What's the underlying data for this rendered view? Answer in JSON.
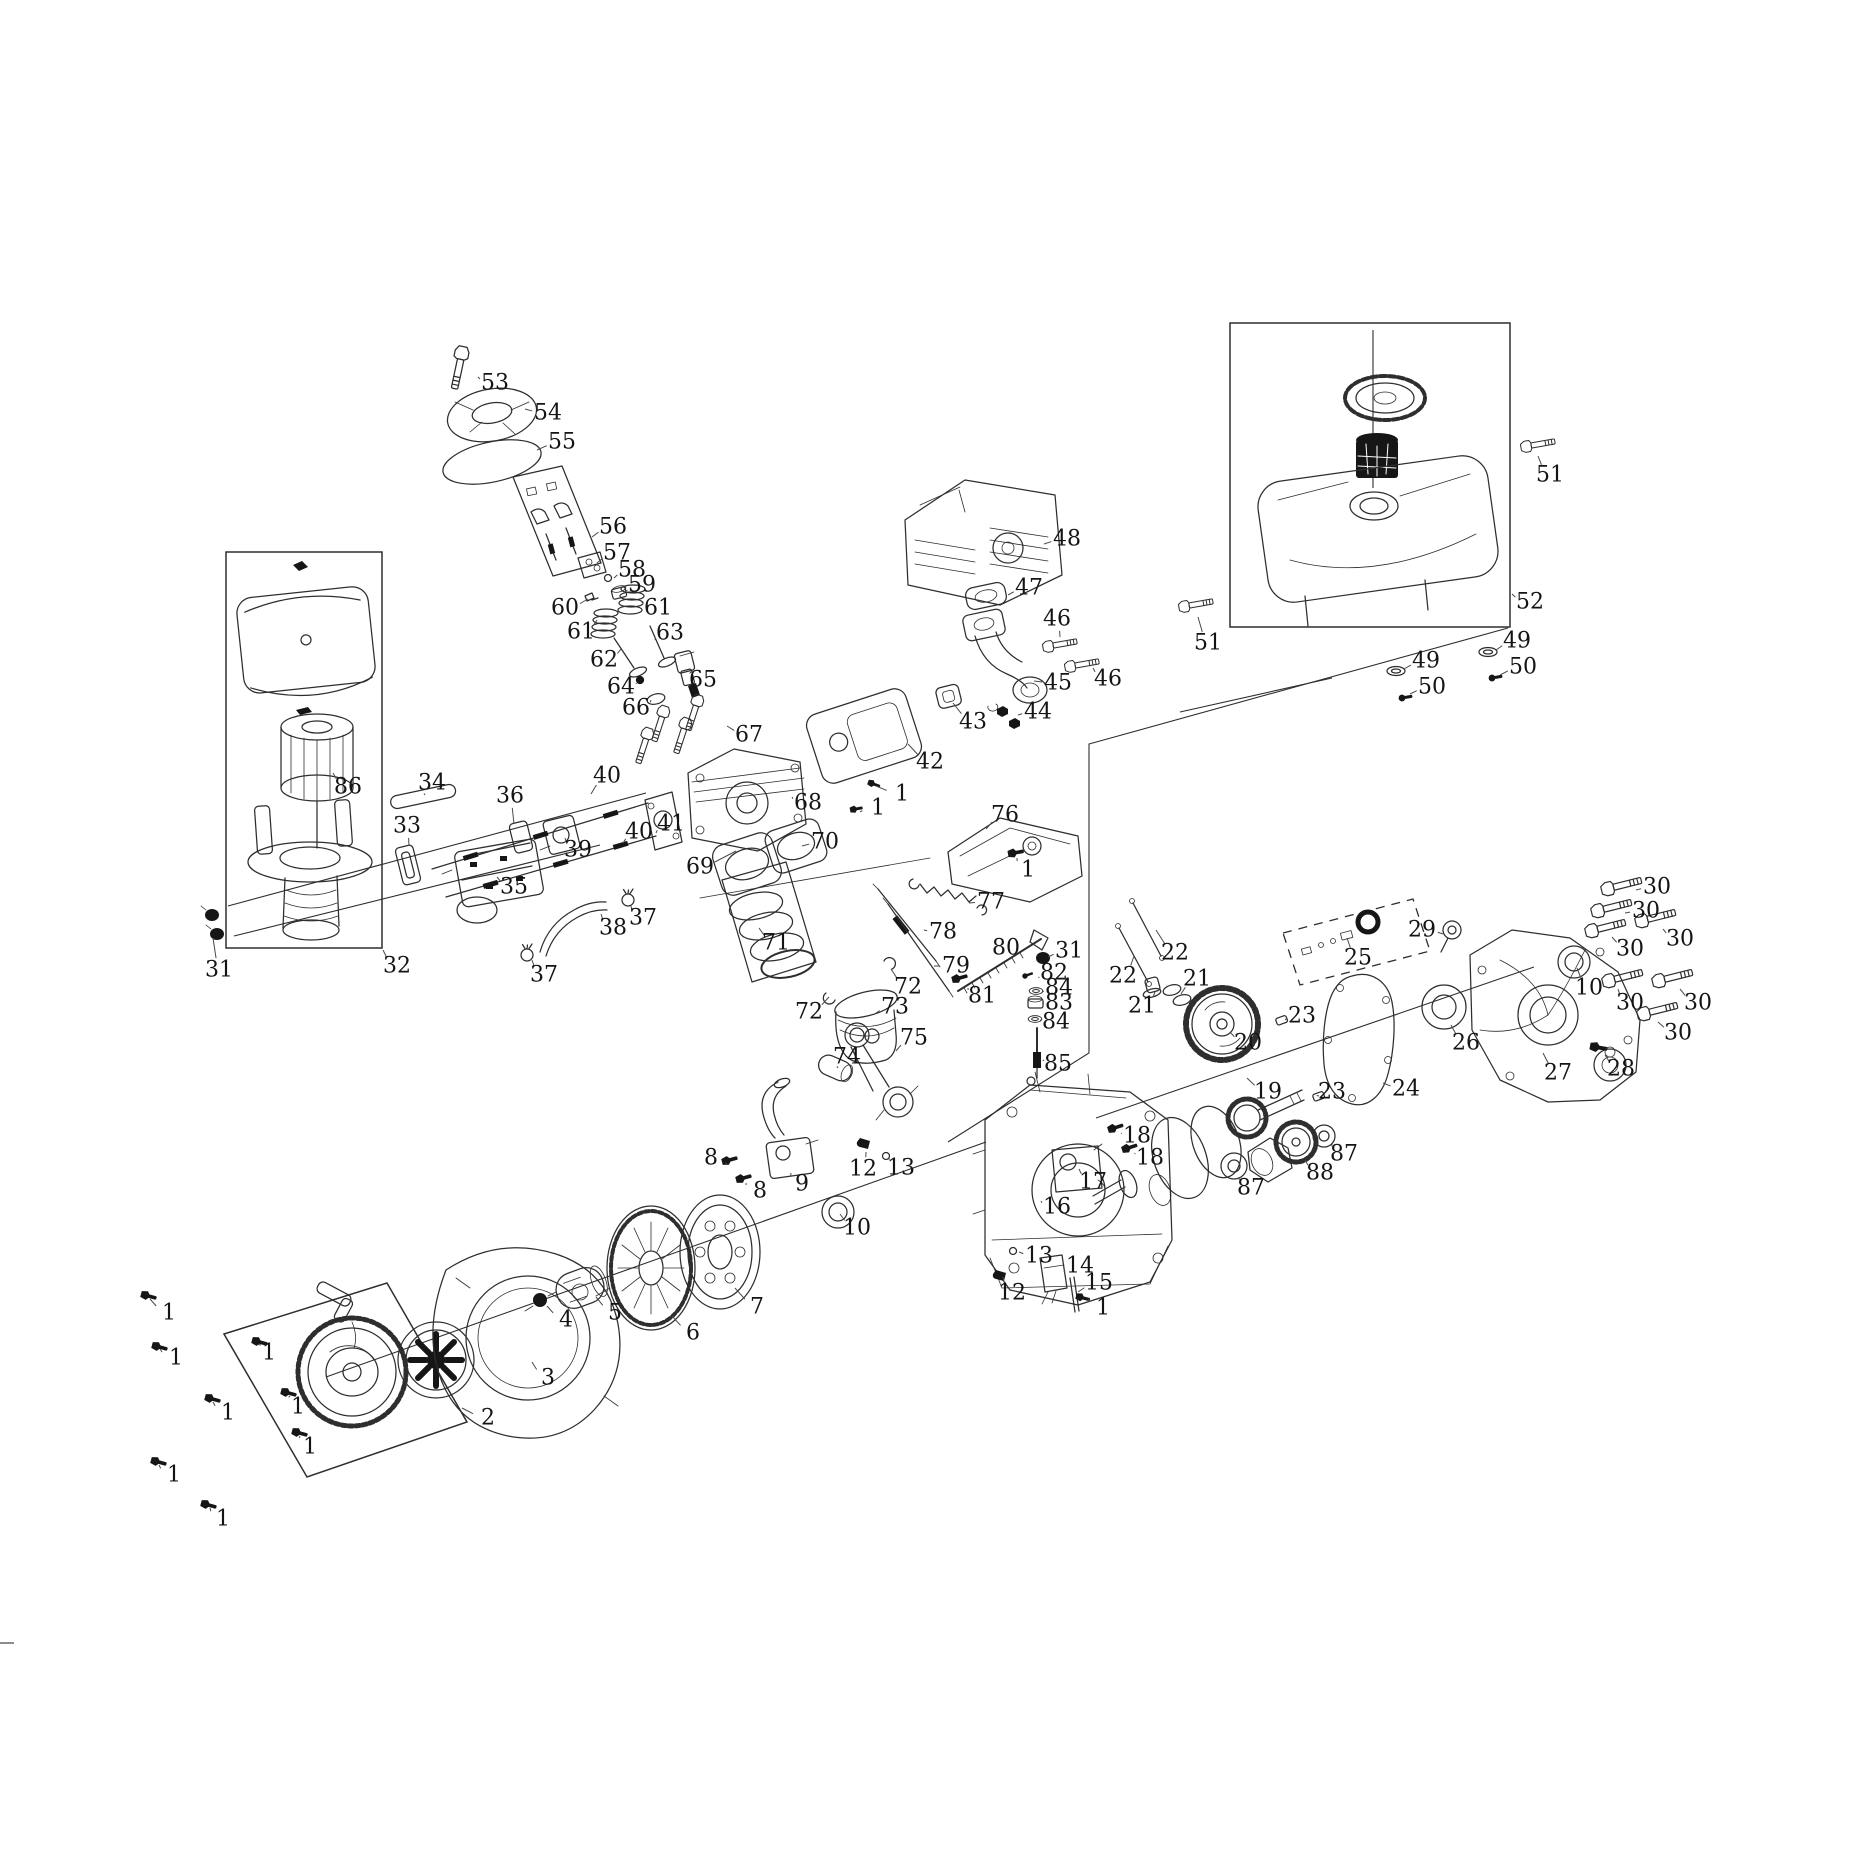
{
  "figure": {
    "kind": "exploded-view-parts-diagram",
    "subject": "small-gasoline-engine",
    "part_number_min": 1,
    "part_number_max": 88,
    "line_color": "#2e2e2e",
    "background_color": "#ffffff"
  },
  "callouts": [
    {
      "n": "53",
      "x": 495,
      "y": 383,
      "tx": 478,
      "ty": 377
    },
    {
      "n": "54",
      "x": 548,
      "y": 413,
      "tx": 525,
      "ty": 409
    },
    {
      "n": "55",
      "x": 562,
      "y": 442,
      "tx": 537,
      "ty": 450
    },
    {
      "n": "56",
      "x": 613,
      "y": 527,
      "tx": 592,
      "ty": 537
    },
    {
      "n": "57",
      "x": 617,
      "y": 553,
      "tx": 597,
      "ty": 563
    },
    {
      "n": "58",
      "x": 632,
      "y": 570,
      "tx": 614,
      "ty": 578
    },
    {
      "n": "59",
      "x": 642,
      "y": 585,
      "tx": 624,
      "ty": 593
    },
    {
      "n": "60",
      "x": 565,
      "y": 608,
      "tx": 588,
      "ty": 599
    },
    {
      "n": "61",
      "x": 658,
      "y": 608,
      "tx": 641,
      "ty": 601
    },
    {
      "n": "61",
      "x": 581,
      "y": 632,
      "tx": 597,
      "ty": 620
    },
    {
      "n": "62",
      "x": 604,
      "y": 660,
      "tx": 621,
      "ty": 649
    },
    {
      "n": "63",
      "x": 670,
      "y": 633,
      "tx": 655,
      "ty": 640
    },
    {
      "n": "64",
      "x": 621,
      "y": 687,
      "tx": 636,
      "ty": 683
    },
    {
      "n": "65",
      "x": 703,
      "y": 680,
      "tx": 691,
      "ty": 672
    },
    {
      "n": "66",
      "x": 636,
      "y": 708,
      "tx": 651,
      "ty": 700
    },
    {
      "n": "67",
      "x": 749,
      "y": 735,
      "tx": 727,
      "ty": 726
    },
    {
      "n": "68",
      "x": 808,
      "y": 803,
      "tx": 792,
      "ty": 797
    },
    {
      "n": "69",
      "x": 700,
      "y": 867,
      "tx": 736,
      "ty": 851
    },
    {
      "n": "70",
      "x": 825,
      "y": 842,
      "tx": 802,
      "ty": 846
    },
    {
      "n": "71",
      "x": 776,
      "y": 943,
      "tx": 759,
      "ty": 928
    },
    {
      "n": "72",
      "x": 908,
      "y": 987,
      "tx": 891,
      "ty": 969
    },
    {
      "n": "72",
      "x": 809,
      "y": 1012,
      "tx": 829,
      "ty": 997
    },
    {
      "n": "73",
      "x": 895,
      "y": 1007,
      "tx": 876,
      "ty": 1013
    },
    {
      "n": "74",
      "x": 847,
      "y": 1057,
      "tx": 838,
      "ty": 1068
    },
    {
      "n": "75",
      "x": 914,
      "y": 1038,
      "tx": 896,
      "ty": 1051
    },
    {
      "n": "76",
      "x": 1005,
      "y": 815,
      "tx": 986,
      "ty": 829
    },
    {
      "n": "77",
      "x": 991,
      "y": 902,
      "tx": 969,
      "ty": 903
    },
    {
      "n": "78",
      "x": 943,
      "y": 932,
      "tx": 924,
      "ty": 930
    },
    {
      "n": "79",
      "x": 956,
      "y": 966,
      "tx": 934,
      "ty": 966
    },
    {
      "n": "80",
      "x": 1006,
      "y": 948,
      "tx": 1009,
      "ty": 959
    },
    {
      "n": "81",
      "x": 982,
      "y": 996,
      "tx": 968,
      "ty": 988
    },
    {
      "n": "82",
      "x": 1054,
      "y": 973,
      "tx": 1039,
      "ty": 978
    },
    {
      "n": "83",
      "x": 1059,
      "y": 1003,
      "tx": 1044,
      "ty": 1003
    },
    {
      "n": "84",
      "x": 1059,
      "y": 988,
      "tx": 1043,
      "ty": 992
    },
    {
      "n": "84",
      "x": 1056,
      "y": 1022,
      "tx": 1041,
      "ty": 1020
    },
    {
      "n": "85",
      "x": 1058,
      "y": 1064,
      "tx": 1044,
      "ty": 1060
    },
    {
      "n": "86",
      "x": 348,
      "y": 787,
      "tx": 333,
      "ty": 773
    },
    {
      "n": "31",
      "x": 219,
      "y": 970,
      "tx": 213,
      "ty": 938
    },
    {
      "n": "31",
      "x": 1069,
      "y": 951,
      "tx": 1048,
      "ty": 957
    },
    {
      "n": "32",
      "x": 397,
      "y": 966,
      "tx": 383,
      "ty": 950
    },
    {
      "n": "33",
      "x": 407,
      "y": 826,
      "tx": 409,
      "ty": 846
    },
    {
      "n": "34",
      "x": 432,
      "y": 783,
      "tx": 425,
      "ty": 795
    },
    {
      "n": "35",
      "x": 514,
      "y": 887,
      "tx": 497,
      "ty": 877
    },
    {
      "n": "36",
      "x": 510,
      "y": 796,
      "tx": 514,
      "ty": 824
    },
    {
      "n": "37",
      "x": 643,
      "y": 918,
      "tx": 631,
      "ty": 906
    },
    {
      "n": "37",
      "x": 544,
      "y": 975,
      "tx": 532,
      "ty": 960
    },
    {
      "n": "38",
      "x": 613,
      "y": 928,
      "tx": 601,
      "ty": 914
    },
    {
      "n": "39",
      "x": 578,
      "y": 850,
      "tx": 565,
      "ty": 838
    },
    {
      "n": "40",
      "x": 607,
      "y": 776,
      "tx": 591,
      "ty": 794
    },
    {
      "n": "40",
      "x": 639,
      "y": 832,
      "tx": 623,
      "ty": 843
    },
    {
      "n": "41",
      "x": 671,
      "y": 824,
      "tx": 656,
      "ty": 833
    },
    {
      "n": "42",
      "x": 930,
      "y": 762,
      "tx": 908,
      "ty": 744
    },
    {
      "n": "43",
      "x": 973,
      "y": 722,
      "tx": 953,
      "ty": 703
    },
    {
      "n": "44",
      "x": 1038,
      "y": 712,
      "tx": 1018,
      "ty": 715
    },
    {
      "n": "45",
      "x": 1058,
      "y": 683,
      "tx": 1034,
      "ty": 681
    },
    {
      "n": "46",
      "x": 1057,
      "y": 619,
      "tx": 1060,
      "ty": 637
    },
    {
      "n": "46",
      "x": 1108,
      "y": 679,
      "tx": 1093,
      "ty": 668
    },
    {
      "n": "47",
      "x": 1029,
      "y": 588,
      "tx": 1008,
      "ty": 595
    },
    {
      "n": "48",
      "x": 1067,
      "y": 539,
      "tx": 1044,
      "ty": 544
    },
    {
      "n": "49",
      "x": 1517,
      "y": 641,
      "tx": 1496,
      "ty": 650
    },
    {
      "n": "49",
      "x": 1426,
      "y": 661,
      "tx": 1404,
      "ty": 669
    },
    {
      "n": "50",
      "x": 1523,
      "y": 667,
      "tx": 1500,
      "ty": 675
    },
    {
      "n": "50",
      "x": 1432,
      "y": 687,
      "tx": 1410,
      "ty": 694
    },
    {
      "n": "51",
      "x": 1550,
      "y": 475,
      "tx": 1538,
      "ty": 456
    },
    {
      "n": "51",
      "x": 1208,
      "y": 643,
      "tx": 1198,
      "ty": 617
    },
    {
      "n": "52",
      "x": 1530,
      "y": 602,
      "tx": 1512,
      "ty": 594
    },
    {
      "n": "1",
      "x": 169,
      "y": 1313,
      "tx": 150,
      "ty": 1299
    },
    {
      "n": "1",
      "x": 176,
      "y": 1358,
      "tx": 160,
      "ty": 1349
    },
    {
      "n": "1",
      "x": 269,
      "y": 1353,
      "tx": 261,
      "ty": 1345
    },
    {
      "n": "1",
      "x": 228,
      "y": 1413,
      "tx": 213,
      "ty": 1402
    },
    {
      "n": "1",
      "x": 298,
      "y": 1407,
      "tx": 290,
      "ty": 1396
    },
    {
      "n": "1",
      "x": 310,
      "y": 1447,
      "tx": 300,
      "ty": 1436
    },
    {
      "n": "1",
      "x": 174,
      "y": 1475,
      "tx": 159,
      "ty": 1465
    },
    {
      "n": "1",
      "x": 223,
      "y": 1519,
      "tx": 210,
      "ty": 1508
    },
    {
      "n": "1",
      "x": 902,
      "y": 794,
      "tx": 876,
      "ty": 786
    },
    {
      "n": "1",
      "x": 878,
      "y": 808,
      "tx": 860,
      "ty": 812
    },
    {
      "n": "1",
      "x": 1028,
      "y": 870,
      "tx": 1017,
      "ty": 858
    },
    {
      "n": "1",
      "x": 1103,
      "y": 1308,
      "tx": 1088,
      "ty": 1299
    },
    {
      "n": "2",
      "x": 488,
      "y": 1418,
      "tx": 462,
      "ty": 1408
    },
    {
      "n": "3",
      "x": 548,
      "y": 1378,
      "tx": 532,
      "ty": 1362
    },
    {
      "n": "4",
      "x": 566,
      "y": 1320,
      "tx": 547,
      "ty": 1306
    },
    {
      "n": "5",
      "x": 615,
      "y": 1313,
      "tx": 596,
      "ty": 1297
    },
    {
      "n": "6",
      "x": 693,
      "y": 1333,
      "tx": 672,
      "ty": 1316
    },
    {
      "n": "7",
      "x": 757,
      "y": 1307,
      "tx": 735,
      "ty": 1288
    },
    {
      "n": "8",
      "x": 711,
      "y": 1158,
      "tx": 726,
      "ty": 1164
    },
    {
      "n": "8",
      "x": 760,
      "y": 1191,
      "tx": 746,
      "ty": 1183
    },
    {
      "n": "9",
      "x": 802,
      "y": 1184,
      "tx": 791,
      "ty": 1173
    },
    {
      "n": "10",
      "x": 857,
      "y": 1228,
      "tx": 840,
      "ty": 1214
    },
    {
      "n": "10",
      "x": 1589,
      "y": 988,
      "tx": 1577,
      "ty": 968
    },
    {
      "n": "12",
      "x": 863,
      "y": 1169,
      "tx": 866,
      "ty": 1152
    },
    {
      "n": "12",
      "x": 1012,
      "y": 1293,
      "tx": 1003,
      "ty": 1277
    },
    {
      "n": "13",
      "x": 901,
      "y": 1168,
      "tx": 889,
      "ty": 1157
    },
    {
      "n": "13",
      "x": 1039,
      "y": 1256,
      "tx": 1019,
      "ty": 1252
    },
    {
      "n": "14",
      "x": 1080,
      "y": 1266,
      "tx": 1064,
      "ty": 1272
    },
    {
      "n": "15",
      "x": 1099,
      "y": 1283,
      "tx": 1078,
      "ty": 1292
    },
    {
      "n": "16",
      "x": 1057,
      "y": 1207,
      "tx": 1041,
      "ty": 1201
    },
    {
      "n": "17",
      "x": 1093,
      "y": 1182,
      "tx": 1079,
      "ty": 1169
    },
    {
      "n": "18",
      "x": 1137,
      "y": 1136,
      "tx": 1122,
      "ty": 1133
    },
    {
      "n": "18",
      "x": 1150,
      "y": 1158,
      "tx": 1135,
      "ty": 1153
    },
    {
      "n": "19",
      "x": 1268,
      "y": 1092,
      "tx": 1247,
      "ty": 1078
    },
    {
      "n": "20",
      "x": 1248,
      "y": 1043,
      "tx": 1230,
      "ty": 1032
    },
    {
      "n": "21",
      "x": 1142,
      "y": 1006,
      "tx": 1155,
      "ty": 992
    },
    {
      "n": "21",
      "x": 1197,
      "y": 979,
      "tx": 1181,
      "ty": 994
    },
    {
      "n": "22",
      "x": 1123,
      "y": 976,
      "tx": 1134,
      "ty": 956
    },
    {
      "n": "22",
      "x": 1175,
      "y": 953,
      "tx": 1156,
      "ty": 930
    },
    {
      "n": "23",
      "x": 1302,
      "y": 1016,
      "tx": 1285,
      "ty": 1020
    },
    {
      "n": "23",
      "x": 1332,
      "y": 1092,
      "tx": 1319,
      "ty": 1096
    },
    {
      "n": "24",
      "x": 1406,
      "y": 1089,
      "tx": 1383,
      "ty": 1083
    },
    {
      "n": "25",
      "x": 1358,
      "y": 958,
      "tx": 1347,
      "ty": 938
    },
    {
      "n": "26",
      "x": 1466,
      "y": 1043,
      "tx": 1451,
      "ty": 1025
    },
    {
      "n": "27",
      "x": 1558,
      "y": 1073,
      "tx": 1543,
      "ty": 1053
    },
    {
      "n": "28",
      "x": 1621,
      "y": 1069,
      "tx": 1605,
      "ty": 1055
    },
    {
      "n": "29",
      "x": 1422,
      "y": 930,
      "tx": 1443,
      "ty": 934
    },
    {
      "n": "30",
      "x": 1657,
      "y": 887,
      "tx": 1636,
      "ty": 890
    },
    {
      "n": "30",
      "x": 1646,
      "y": 911,
      "tx": 1625,
      "ty": 913
    },
    {
      "n": "30",
      "x": 1680,
      "y": 939,
      "tx": 1663,
      "ty": 929
    },
    {
      "n": "30",
      "x": 1630,
      "y": 949,
      "tx": 1612,
      "ty": 937
    },
    {
      "n": "30",
      "x": 1630,
      "y": 1003,
      "tx": 1618,
      "ty": 989
    },
    {
      "n": "30",
      "x": 1698,
      "y": 1003,
      "tx": 1680,
      "ty": 989
    },
    {
      "n": "30",
      "x": 1678,
      "y": 1033,
      "tx": 1658,
      "ty": 1022
    },
    {
      "n": "87",
      "x": 1251,
      "y": 1188,
      "tx": 1239,
      "ty": 1177
    },
    {
      "n": "87",
      "x": 1344,
      "y": 1154,
      "tx": 1332,
      "ty": 1144
    },
    {
      "n": "88",
      "x": 1320,
      "y": 1173,
      "tx": 1305,
      "ty": 1160
    }
  ]
}
